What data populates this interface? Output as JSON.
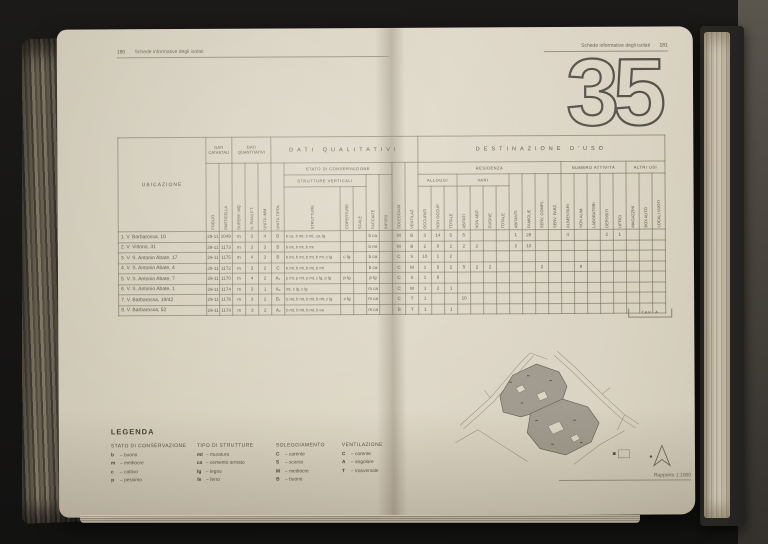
{
  "palette": {
    "paper": "#d9d2c2",
    "ink": "#4c4539",
    "rule": "#6c675d",
    "background": "#161514"
  },
  "left_page": {
    "header": {
      "page_number": "180",
      "title": "Schede informative degli isolati"
    },
    "legend": {
      "title": "LEGENDA",
      "groups": [
        {
          "title": "STATO DI CONSERVAZIONE",
          "items": [
            {
              "key": "b",
              "label": "buono"
            },
            {
              "key": "m",
              "label": "mediocre"
            },
            {
              "key": "c",
              "label": "cattivo"
            },
            {
              "key": "p",
              "label": "pessimo"
            }
          ]
        },
        {
          "title": "TIPO DI STRUTTURE",
          "items": [
            {
              "key": "mt",
              "label": "muratura"
            },
            {
              "key": "ca",
              "label": "cemento armato"
            },
            {
              "key": "lg",
              "label": "legno"
            },
            {
              "key": "fe",
              "label": "ferro"
            }
          ]
        },
        {
          "title": "SOLEGGIAMENTO",
          "items": [
            {
              "key": "C",
              "label": "carente"
            },
            {
              "key": "S",
              "label": "scarso"
            },
            {
              "key": "M",
              "label": "mediocre"
            },
            {
              "key": "B",
              "label": "buono"
            }
          ]
        },
        {
          "title": "VENTILAZIONE",
          "items": [
            {
              "key": "C",
              "label": "carente"
            },
            {
              "key": "A",
              "label": "angolare"
            },
            {
              "key": "T",
              "label": "trasversale"
            }
          ]
        }
      ]
    }
  },
  "right_page": {
    "header": {
      "title": "Schede informative degli isolati",
      "page_number": "181"
    },
    "block_number": "35",
    "map": {
      "caption": "Rapporto 1:1000"
    }
  },
  "table": {
    "corner_label": "TAV. A",
    "ubicazione_header": "UBICAZIONE",
    "groups": {
      "catastali": "DATI CATASTALI",
      "quantitativi": "DATI QUANTITATIVI",
      "qualitativi": "DATI QUALITATIVI",
      "destinazione": "DESTINAZIONE D'USO",
      "stato": "STATO DI CONSERVAZIONE",
      "strutture_vert": "STRUTTURE VERTICALI",
      "residenza": "RESIDENZA",
      "alloggi": "ALLOGGI",
      "vani": "VANI",
      "attivita": "NUMERO ATTIVITÀ",
      "altri": "ALTRI USI"
    },
    "columns": [
      "FOGLIO",
      "PARTICELLA",
      "SUPERF. MQ",
      "N. PIANI F.T.",
      "UNITÀ IMM.",
      "UNITÀ TIPOL.",
      "STRUTTURE",
      "COPERTURE",
      "SCALE",
      "FACCIATE",
      "INFISSI",
      "SOLEGGIAM.",
      "VENTILAZ.",
      "OCCUPATI",
      "NON OCCUP.",
      "TOTALE",
      "ABITATI",
      "NON ABIT.",
      "CUCINE",
      "TOTALE",
      "ABITANTI",
      "FAMIGLIE",
      "SERV. COMPL.",
      "SERV. PARZ.",
      "ALIMENTARI",
      "NON ALIM.",
      "LABORATORI",
      "DEPOSITI",
      "UFFICI",
      "MAGAZZINI",
      "BOX AUTO",
      "LOCALI VUOTI"
    ],
    "rows": [
      {
        "label": "1. V. Barbarossa, 10",
        "cells": [
          "29-11",
          "1049",
          "m",
          "3",
          "4",
          "B",
          "b ca, b mt, b mt, ca, lg",
          "",
          "",
          "b ca",
          "",
          "M",
          "B",
          "3",
          "14",
          "5",
          "5",
          "",
          "",
          "",
          "1",
          "28",
          "",
          "",
          "4",
          "",
          "",
          "2",
          "1",
          "",
          "",
          ""
        ]
      },
      {
        "label": "2. V. Vittorio, 31",
        "cells": [
          "29-11",
          "1173",
          "m",
          "3",
          "3",
          "B",
          "b mt, b mt, b mt",
          "",
          "",
          "b mt",
          "",
          "M",
          "B",
          "2",
          "8",
          "2",
          "2",
          "2",
          "",
          "",
          "2",
          "10",
          "",
          "",
          "",
          "",
          "",
          "",
          "",
          "",
          "",
          ""
        ]
      },
      {
        "label": "3. V. S. Antonio Abate, 17",
        "cells": [
          "29-11",
          "1175",
          "m",
          "4",
          "3",
          "B",
          "b mt, b mt, b mt, b mt, c lg",
          "c lg",
          "",
          "b ca",
          "",
          "C",
          "S",
          "10",
          "1",
          "2",
          "",
          "",
          "",
          "",
          "",
          "",
          "",
          "",
          "",
          "",
          "",
          "",
          "",
          "",
          "",
          ""
        ]
      },
      {
        "label": "4. V. S. Antonio Abate, 4",
        "cells": [
          "29-11",
          "1172",
          "m",
          "3",
          "2",
          "C",
          "b mt, b mt, b mt, b mt",
          "",
          "",
          "b ca",
          "",
          "C",
          "M",
          "1",
          "5",
          "2",
          "5",
          "2",
          "2",
          "",
          "",
          "",
          "2",
          "",
          "",
          "8",
          "",
          "",
          "",
          "",
          "",
          ""
        ]
      },
      {
        "label": "5. V. S. Antonio Abate, 7",
        "cells": [
          "29-11",
          "1170",
          "m",
          "4",
          "2",
          "A₂",
          "p mt, p mt, p mt, c lg, p lg",
          "p lg",
          "",
          "p lg",
          "",
          "C",
          "S",
          "1",
          "6",
          "",
          "",
          "",
          "",
          "",
          "",
          "",
          "",
          "",
          "",
          "",
          "",
          "",
          "",
          "",
          "",
          ""
        ]
      },
      {
        "label": "6. V. S. Antonio Abate, 1",
        "cells": [
          "29-11",
          "1174",
          "m",
          "3",
          "1",
          "A₂",
          "mt, c lg, c lg",
          "",
          "",
          "m ca",
          "",
          "C",
          "M",
          "1",
          "2",
          "1",
          "",
          "",
          "",
          "",
          "",
          "",
          "",
          "",
          "",
          "",
          "",
          "",
          "",
          "",
          "",
          ""
        ]
      },
      {
        "label": "7. V. Barbarossa, 19/42",
        "cells": [
          "29-11",
          "1176",
          "m",
          "3",
          "2",
          "B₁",
          "b mt, b mt, b mt, b mt, c lg",
          "c lg",
          "",
          "m ca",
          "",
          "C",
          "T",
          "1",
          "",
          "",
          "10",
          "",
          "",
          "",
          "",
          "",
          "",
          "",
          "",
          "",
          "",
          "",
          "",
          "",
          "",
          ""
        ]
      },
      {
        "label": "8. V. Barbarossa, 52",
        "cells": [
          "29-11",
          "1178",
          "m",
          "3",
          "2",
          "A₂",
          "b mt, b mt, b mt, b ca",
          "",
          "",
          "m ca",
          "",
          "B",
          "T",
          "1",
          "",
          "1",
          "",
          "",
          "",
          "",
          "",
          "",
          "",
          "",
          "",
          "",
          "",
          "",
          "",
          "",
          "",
          ""
        ]
      }
    ]
  }
}
